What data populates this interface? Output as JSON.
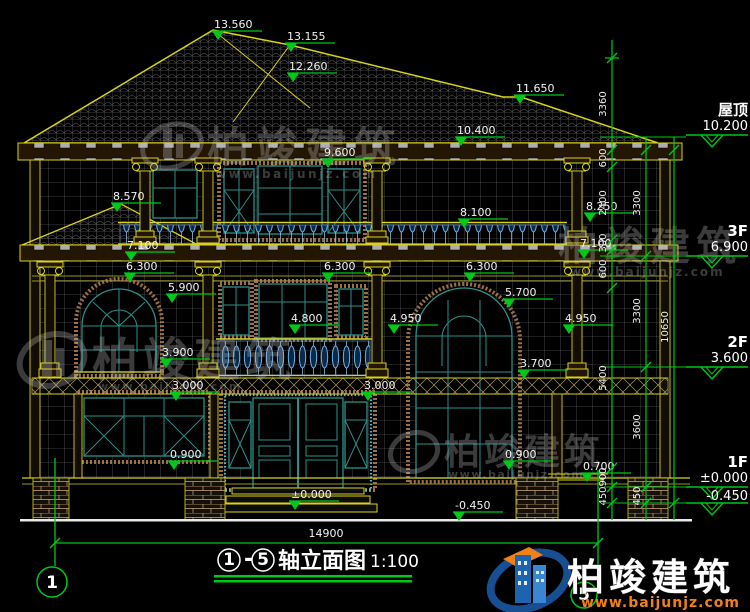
{
  "drawing_title": {
    "axis_from": "1",
    "dash": "-",
    "axis_to": "5",
    "name": "轴立面图",
    "scale": "1:100"
  },
  "axis_bubbles": {
    "left": "1",
    "right": "5"
  },
  "overall_width": "14900",
  "elevation_marks": [
    "13.560",
    "13.155",
    "12.260",
    "11.650",
    "10.400",
    "9.600",
    "8.570",
    "8.100",
    "8.250",
    "7.100",
    "7.100",
    "6.300",
    "6.300",
    "6.300",
    "5.900",
    "5.700",
    "4.950",
    "4.950",
    "4.800",
    "3.900",
    "3.700",
    "3.000",
    "3.000",
    "0.900",
    "0.900",
    "0.700",
    "±0.000",
    "-0.450"
  ],
  "floor_marks": [
    {
      "name": "屋顶",
      "level": "10.200"
    },
    {
      "name": "3F",
      "level": "6.900"
    },
    {
      "name": "2F",
      "level": "3.600"
    },
    {
      "name": "1F",
      "level": "±0.000"
    },
    {
      "name": "",
      "level": "-0.450"
    }
  ],
  "dim_chains": {
    "inner": [
      "3360",
      "600",
      "2400",
      "300",
      "600",
      "5400",
      "900",
      "450"
    ],
    "middle": [
      "3300",
      "3300",
      "3600",
      "450"
    ],
    "outer": [
      "10650"
    ]
  },
  "watermark": {
    "brand": "柏竣建筑",
    "site": "www.baijunjz.com"
  },
  "logo": {
    "brand": "柏竣建筑",
    "site": "www.baijunjz.com"
  },
  "colors": {
    "background": "#000000",
    "cad_yellow": "#d8d21c",
    "cad_green": "#00c818",
    "window_teal": "#2d8f88",
    "baluster_blue": "#6fb0e6",
    "surround_tan": "#b5834f",
    "logo_orange": "#f08019",
    "logo_blue": "#1c63b0"
  }
}
